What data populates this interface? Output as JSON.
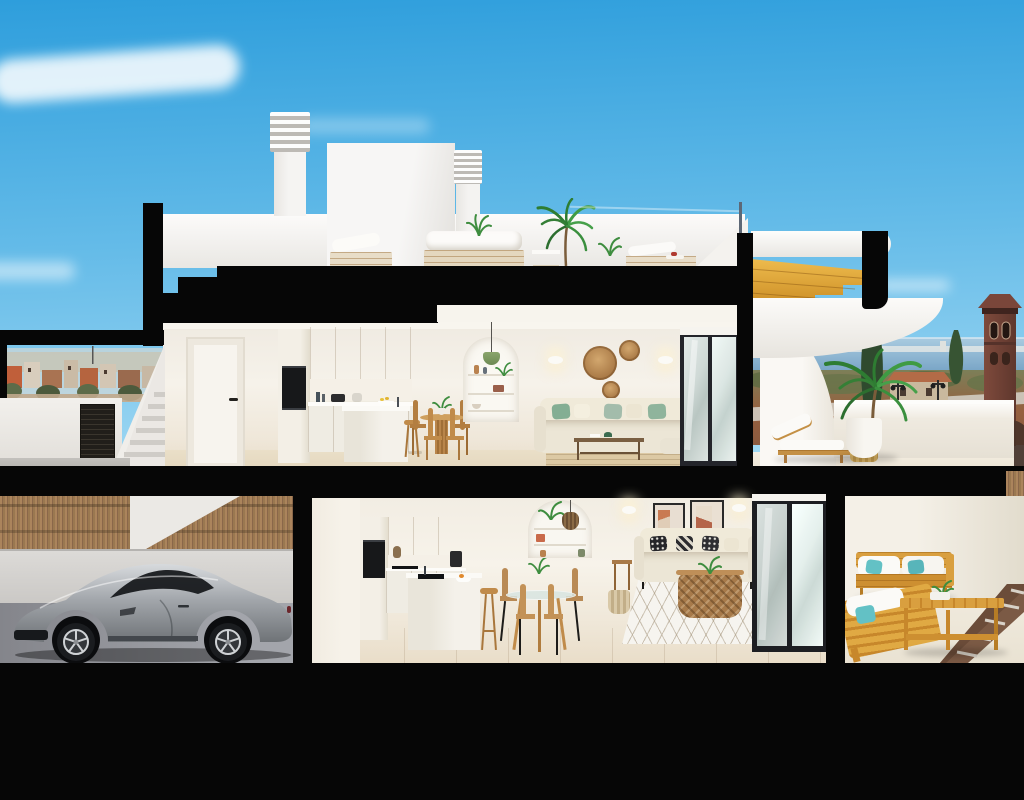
{
  "meta": {
    "kind": "architectural cross-section 3D render",
    "subject": "two-storey coastal townhouse cutaway with roof terrace, garage and patios",
    "visible_text": ""
  },
  "palette": {
    "ink": "#060606",
    "skyTop": "#2e9edc",
    "skyMid": "#64bbe8",
    "skyLow": "#aaddf4",
    "wall": "#f2eee5",
    "ceil": "#f7f4ed",
    "floorUp": "#e8ddc8",
    "woodCab": "#d7b87d",
    "woodCabD": "#c2a262",
    "chairWood": "#c08b4a",
    "island": "#f3f0e9",
    "ovenBlack": "#17181a",
    "sofa": "#ece6d6",
    "pillowGreen": "#84ae93",
    "pillowTeal": "#63c1c5",
    "rattan": "#b57f47",
    "stairGold": "#e3ab3a",
    "fence": "#a8825c",
    "garWall": "#d6d4d1",
    "garFloor": "#8f9197",
    "carBody": "#a9adb2",
    "sea": "#6f9dc1",
    "tower": "#6e4034",
    "cypress": "#2f4a2e",
    "patioWood": "#d99f3f",
    "gravel": "#7b5a45",
    "rugJute": "#dcc9a4",
    "rugWhite": "#f6f4ef"
  },
  "scene": {
    "sky": {
      "cloud_count": 3
    },
    "background_left": {
      "type": "town-skyline",
      "features": [
        "terracotta-roofs",
        "white-houses",
        "trees",
        "antenna"
      ]
    },
    "background_right": {
      "type": "sea-horizon",
      "features": [
        "distant-city-strip",
        "watchtower",
        "cypress-trees",
        "street-lamps",
        "terracotta-house",
        "scrubland"
      ]
    },
    "roof_terrace": {
      "chimneys": 2,
      "items": [
        "stair-bulkhead",
        "outdoor-sofa",
        "lounge-chairs",
        "potted-palm",
        "glass-railing-post"
      ]
    },
    "upper_floor": {
      "rooms": [
        "kitchen",
        "dining",
        "living"
      ],
      "items": [
        "white-door",
        "double-oven-column",
        "oak-upper-cabinets",
        "kitchen-island",
        "bar-stools",
        "round-dining-table",
        "wooden-chairs",
        "arched-niche",
        "green-pendant-lamp",
        "wall-sconces",
        "rattan-wall-discs",
        "beige-sofa",
        "green-pillows",
        "coffee-table",
        "jute-rug",
        "sliding-glass-doors"
      ]
    },
    "upper_terrace": {
      "items": [
        "curved-privacy-wall",
        "sun-lounger",
        "drum-side-table",
        "potted-palm",
        "parapet-wall"
      ]
    },
    "exterior_stair_right": {
      "material": "golden-wood-steps",
      "items": [
        "white-eyebrow-roof",
        "black-columns",
        "curved-underside"
      ]
    },
    "lower_floor": {
      "rooms": [
        "kitchen",
        "dining",
        "living"
      ],
      "items": [
        "oak-upper-cabinets",
        "induction-hob",
        "island-with-sink",
        "bar-stool",
        "glass-round-table",
        "wooden-chairs",
        "arched-niche",
        "rattan-pendant",
        "two-art-frames",
        "beige-sofa",
        "patterned-pillows",
        "wicker-basket-table",
        "diamond-rug",
        "sliding-glass-doors",
        "woven-basket"
      ]
    },
    "patio": {
      "items": [
        "teak-sofa-set",
        "white-cushions",
        "teal-pillows",
        "slatted-coffee-table",
        "gravel-strip-with-pavers"
      ]
    },
    "garage": {
      "items": [
        "silver-sports-coupe",
        "bamboo-fence",
        "white-wall",
        "paved-floor"
      ]
    },
    "left_court": {
      "items": [
        "white-wall",
        "dark-louvered-gate",
        "exterior-stairs"
      ]
    }
  }
}
